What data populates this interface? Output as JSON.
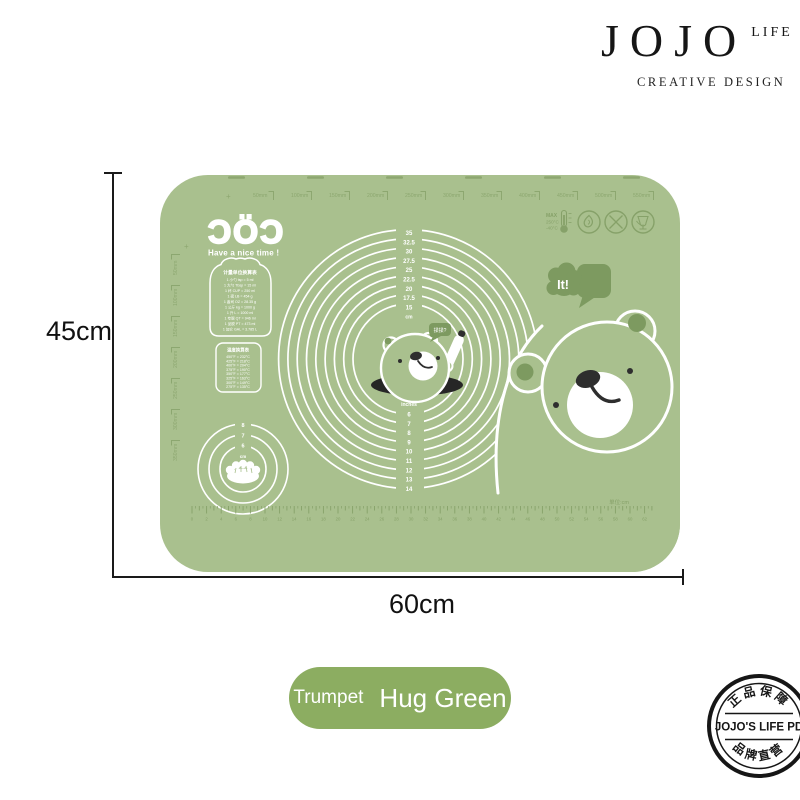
{
  "brand": {
    "name": "JOJO",
    "suffix": "LIFE",
    "tagline": "CREATIVE DESIGN"
  },
  "dimensions": {
    "height": "45cm",
    "width": "60cm"
  },
  "product": {
    "size_label": "Trumpet",
    "variant_label": "Hug Green"
  },
  "stamp": {
    "arc_top": "正品保障",
    "center": "JOJO'S LIFE PD",
    "arc_bottom": "品牌直营"
  },
  "mat": {
    "logo": "ƆÖƆ",
    "logo_tagline": "Have a nice time !",
    "plus_mark": "+",
    "speech_bubble": "It!",
    "bear_speech": "揉揉?",
    "unit_note": "单位:cm",
    "max_temp": {
      "line1": "MAX",
      "line2": "250°C",
      "line3": "-40°C"
    },
    "icons": [
      "thermometer-icon",
      "flame-icon",
      "no-cutting-icon",
      "food-safe-icon"
    ],
    "top_ruler_labels": [
      "50mm",
      "100mm",
      "150mm",
      "200mm",
      "250mm",
      "300mm",
      "350mm",
      "400mm",
      "450mm",
      "500mm",
      "550mm"
    ],
    "left_ruler_labels": [
      "50mm",
      "100mm",
      "150mm",
      "200mm",
      "250mm",
      "300mm",
      "350mm"
    ],
    "circle_cm_labels": [
      "35",
      "32.5",
      "30",
      "27.5",
      "25",
      "22.5",
      "20",
      "17.5",
      "15",
      "cm"
    ],
    "circle_inch_labels": [
      "inches",
      "6",
      "7",
      "8",
      "9",
      "10",
      "11",
      "12",
      "13",
      "14"
    ],
    "dumpling_circle_labels": [
      "8",
      "7",
      "6",
      "cm"
    ],
    "conversion_table": {
      "title": "计量单位换算表",
      "rows": [
        "1 小勺 tsp = 5 ml",
        "1 大勺 Tbsp = 15 ml",
        "1 杯 CUP = 250 ml",
        "1 磅 LB = 454 g",
        "1 盎司 OZ = 28.35 g",
        "1 公斤 kg = 1000 g",
        "1 升 L = 1000 ml",
        "1 夸脱 QT = 946 ml",
        "1 品脱 PT = 473 ml",
        "1 加仑 GAL = 3.785 L"
      ]
    },
    "temperature_table": {
      "title": "温度换算表",
      "rows": [
        "450°F = 232°C",
        "425°F = 218°C",
        "400°F = 204°C",
        "375°F = 190°C",
        "350°F = 177°C",
        "325°F = 163°C",
        "300°F = 149°C",
        "275°F = 135°C"
      ]
    },
    "bottom_ruler_numbers": [
      0,
      2,
      4,
      6,
      8,
      10,
      12,
      14,
      16,
      18,
      20,
      22,
      24,
      26,
      28,
      30,
      32,
      34,
      36,
      38,
      40,
      42,
      44,
      46,
      48,
      50,
      52,
      54,
      56,
      58,
      60,
      62
    ]
  },
  "colors": {
    "mat_green": "#a9c08e",
    "mark_green": "#86a169",
    "dark_green": "#7d9a60",
    "pill_green": "#8cad61",
    "ink": "#1a1a1a",
    "bear_dark": "#2e2e2e",
    "white": "#ffffff"
  }
}
